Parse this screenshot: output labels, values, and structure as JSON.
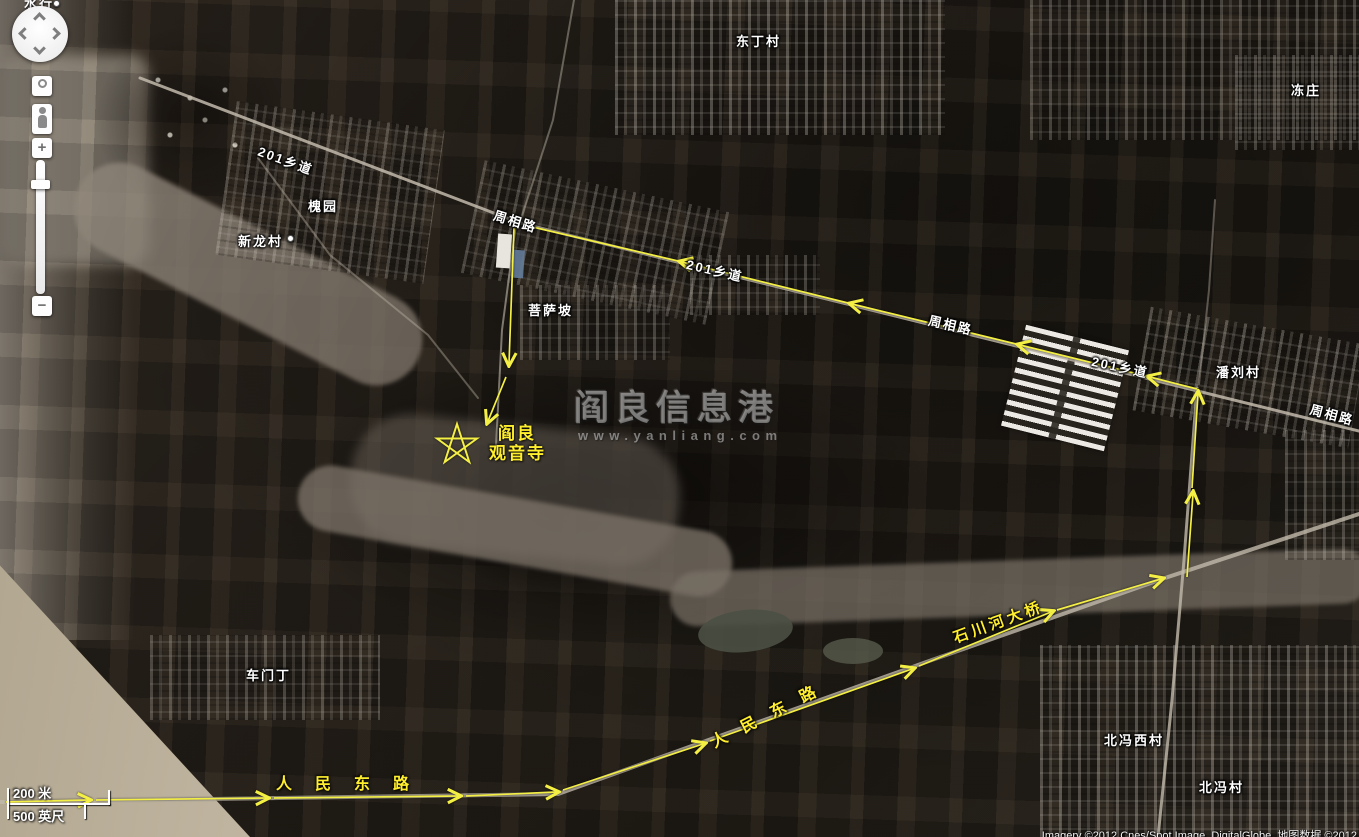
{
  "app": {
    "type": "satellite-map-viewer"
  },
  "colors": {
    "route_yellow": "#f4ef45",
    "road_gray": "#c2baab",
    "label_white": "#ffffff",
    "label_yellow": "#ffee2e"
  },
  "controls": {
    "zoom_in": "+",
    "zoom_out": "−"
  },
  "scale": {
    "meters": "200 米",
    "feet": "500 英尺"
  },
  "watermark": {
    "title": "阎良信息港",
    "url": "www.yanliang.com"
  },
  "attribution": "Imagery ©2012 Cnes/Spot Image, DigitalGlobe, 地图数据 ©2012",
  "top_partial_label": "水行",
  "destination": {
    "line1": "阎良",
    "line2": "观音寺"
  },
  "place_labels": [
    {
      "text": "东丁村",
      "x": 736,
      "y": 31
    },
    {
      "text": "冻庄",
      "x": 1291,
      "y": 80
    },
    {
      "text": "201乡道",
      "x": 262,
      "y": 141,
      "rot": 20
    },
    {
      "text": "周相路",
      "x": 497,
      "y": 205,
      "rot": 17
    },
    {
      "text": "槐园",
      "x": 308,
      "y": 196
    },
    {
      "text": "新龙村",
      "x": 238,
      "y": 231,
      "dot": true
    },
    {
      "text": "菩萨坡",
      "x": 528,
      "y": 300
    },
    {
      "text": "201乡道",
      "x": 689,
      "y": 254,
      "rot": 13
    },
    {
      "text": "周相路",
      "x": 931,
      "y": 310,
      "rot": 13
    },
    {
      "text": "201乡道",
      "x": 1094,
      "y": 351,
      "rot": 12
    },
    {
      "text": "潘刘村",
      "x": 1216,
      "y": 362
    },
    {
      "text": "周相路",
      "x": 1313,
      "y": 399,
      "rot": 15
    },
    {
      "text": "车门丁",
      "x": 246,
      "y": 665
    },
    {
      "text": "北冯西村",
      "x": 1104,
      "y": 730
    },
    {
      "text": "北冯村",
      "x": 1199,
      "y": 777
    }
  ],
  "road_labels": [
    {
      "text": "人民东路",
      "x": 276,
      "y": 770,
      "rot": 0,
      "spacing": 23,
      "size": 16
    },
    {
      "text": "人民东路",
      "x": 706,
      "y": 731,
      "rot": -27,
      "spacing": 17,
      "size": 16
    },
    {
      "text": "石川河大桥",
      "x": 950,
      "y": 628,
      "rot": -20,
      "spacing": 4,
      "size": 15
    }
  ],
  "star": {
    "cx": 457,
    "cy": 445,
    "r": 21
  },
  "route": {
    "segments": [
      {
        "pts": [
          [
            1197,
            389
          ],
          [
            1150,
            377
          ]
        ]
      },
      {
        "pts": [
          [
            1146,
            376
          ],
          [
            1020,
            345
          ]
        ]
      },
      {
        "pts": [
          [
            1016,
            344
          ],
          [
            852,
            304
          ]
        ]
      },
      {
        "pts": [
          [
            848,
            303
          ],
          [
            682,
            262
          ]
        ]
      },
      {
        "pts": [
          [
            678,
            261
          ],
          [
            524,
            225
          ]
        ],
        "arrow": false
      },
      {
        "pts": [
          [
            514,
            228
          ],
          [
            509,
            363
          ]
        ]
      },
      {
        "pts": [
          [
            506,
            377
          ],
          [
            488,
            421
          ]
        ]
      },
      {
        "pts": [
          [
            1187,
            577
          ],
          [
            1193,
            494
          ]
        ]
      },
      {
        "pts": [
          [
            1192,
            488
          ],
          [
            1198,
            394
          ]
        ]
      },
      {
        "pts": [
          [
            6,
            802
          ],
          [
            88,
            800
          ]
        ]
      },
      {
        "pts": [
          [
            96,
            800
          ],
          [
            266,
            798
          ]
        ]
      },
      {
        "pts": [
          [
            274,
            798
          ],
          [
            458,
            796
          ]
        ]
      },
      {
        "pts": [
          [
            466,
            796
          ],
          [
            556,
            792
          ]
        ]
      },
      {
        "pts": [
          [
            563,
            790
          ],
          [
            703,
            744
          ]
        ]
      },
      {
        "pts": [
          [
            710,
            741
          ],
          [
            912,
            669
          ]
        ]
      },
      {
        "pts": [
          [
            919,
            666
          ],
          [
            1051,
            612
          ]
        ]
      },
      {
        "pts": [
          [
            1057,
            610
          ],
          [
            1161,
            579
          ]
        ]
      }
    ]
  },
  "roads": [
    {
      "pts": [
        [
          140,
          78
        ],
        [
          520,
          223
        ],
        [
          1359,
          431
        ]
      ],
      "w": 3,
      "o": 0.85
    },
    {
      "pts": [
        [
          516,
          224
        ],
        [
          502,
          330
        ],
        [
          496,
          446
        ]
      ],
      "w": 2,
      "o": 0.6
    },
    {
      "pts": [
        [
          1197,
          388
        ],
        [
          1184,
          560
        ],
        [
          1172,
          700
        ],
        [
          1158,
          837
        ]
      ],
      "w": 3,
      "o": 0.8
    },
    {
      "pts": [
        [
          0,
          802
        ],
        [
          558,
          794
        ],
        [
          932,
          660
        ],
        [
          1168,
          577
        ],
        [
          1359,
          514
        ]
      ],
      "w": 4,
      "o": 0.8
    },
    {
      "pts": [
        [
          520,
          222
        ],
        [
          553,
          120
        ],
        [
          574,
          0
        ]
      ],
      "w": 2,
      "o": 0.45
    },
    {
      "pts": [
        [
          258,
          158
        ],
        [
          330,
          255
        ],
        [
          428,
          335
        ],
        [
          478,
          398
        ]
      ],
      "w": 2,
      "o": 0.4
    },
    {
      "pts": [
        [
          1199,
          384
        ],
        [
          1209,
          290
        ],
        [
          1215,
          200
        ]
      ],
      "w": 2,
      "o": 0.4
    }
  ]
}
